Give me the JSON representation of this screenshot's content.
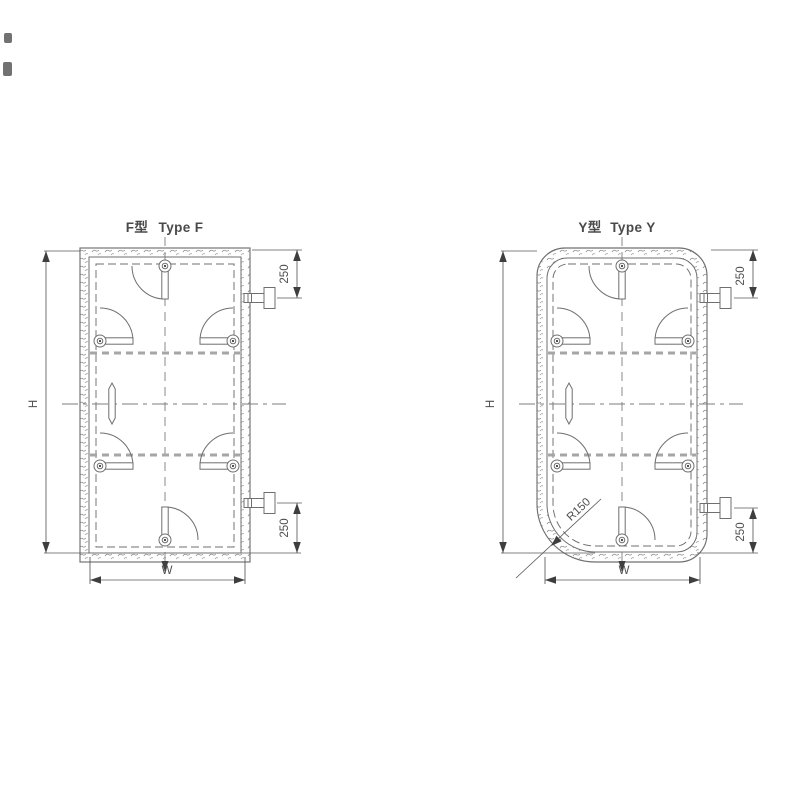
{
  "document": {
    "kind": "technical drawing, two door elevation views",
    "background": "#ffffff"
  },
  "colors": {
    "background": "#ffffff",
    "line": "#6f6f6f",
    "dim_line": "#5a5a5a",
    "text": "#4a4a4a",
    "arrow": "#3e3e3e",
    "stiffener": "#a6a6a6"
  },
  "panels": [
    {
      "id": "type-f",
      "title_cn": "F型",
      "title_en": "Type F",
      "dims": {
        "height": "H",
        "width": "W",
        "top_hinge_offset": "250",
        "bottom_hinge_offset": "250"
      }
    },
    {
      "id": "type-y",
      "title_cn": "Y型",
      "title_en": "Type Y",
      "dims": {
        "height": "H",
        "width": "W",
        "top_hinge_offset": "250",
        "bottom_hinge_offset": "250",
        "corner_radius": "R150"
      }
    }
  ]
}
